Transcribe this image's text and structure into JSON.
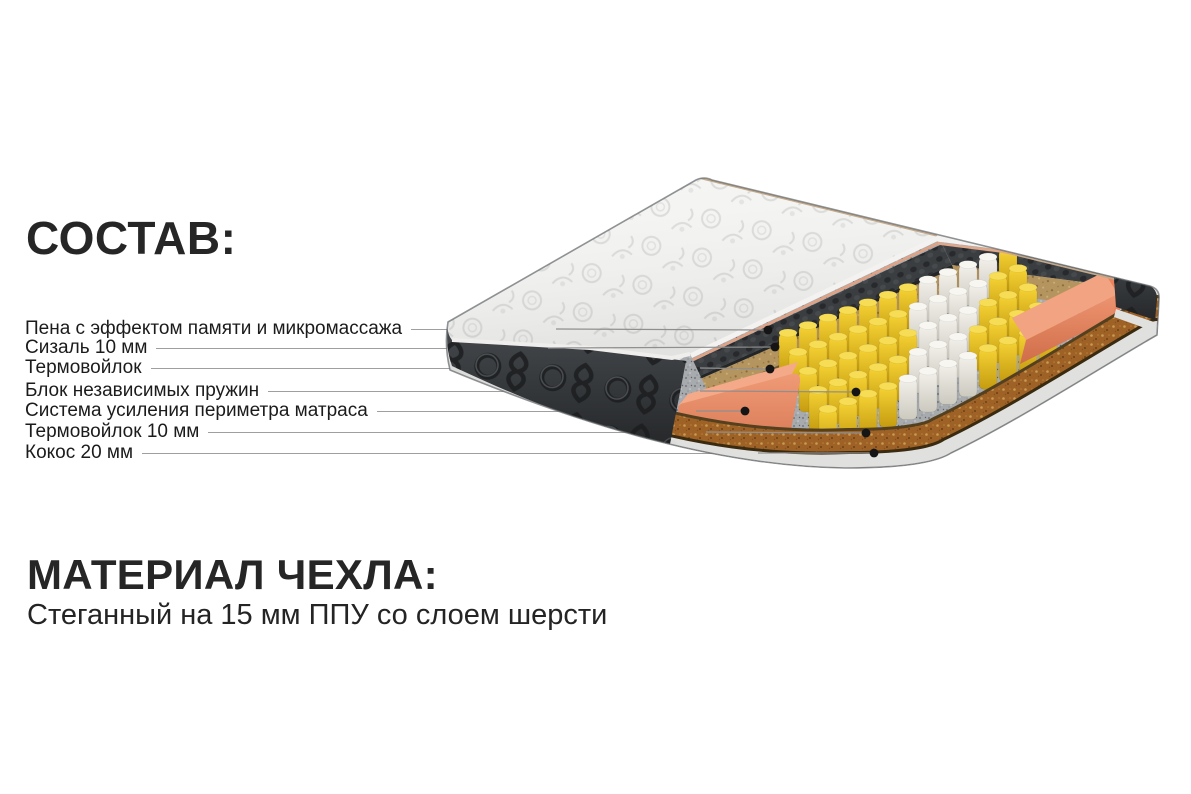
{
  "composition": {
    "title": "СОСТАВ:",
    "items": [
      {
        "label": "Пена с эффектом памяти и микромассажа"
      },
      {
        "label": "Сизаль 10 мм"
      },
      {
        "label": "Термовойлок"
      },
      {
        "label": "Блок независимых пружин"
      },
      {
        "label": "Система усиления периметра матраса"
      },
      {
        "label": "Термовойлок 10 мм"
      },
      {
        "label": "Кокос 20 мм"
      }
    ]
  },
  "cover_material": {
    "title": "МАТЕРИАЛ ЧЕХЛА:",
    "description": "Стеганный на 15 мм ППУ со слоем шерсти"
  },
  "colors": {
    "background": "#ffffff",
    "text": "#262626",
    "leader_line": "#9f9f9f",
    "dot": "#151515",
    "cover_white": "#f4f4f2",
    "quilt_pattern_gray": "#dcdcda",
    "side_panel_black": "#383b3d",
    "memory_foam_gray": "#3a3d40",
    "sisal_tan": "#b5955f",
    "felt_gray": "#a7abae",
    "spring_yellow": "#f1c92a",
    "spring_white": "#efede6",
    "perimeter_foam_orange": "#ea8f6c",
    "coconut_brown": "#9f6226",
    "bottom_tape_gray": "#e0e0de"
  }
}
